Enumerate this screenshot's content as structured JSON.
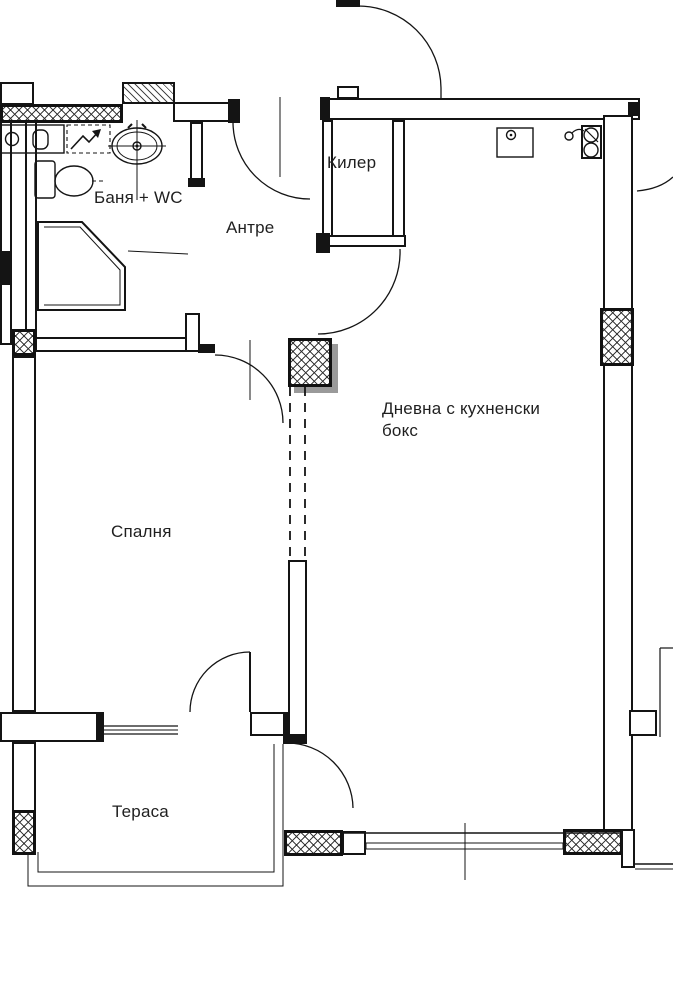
{
  "plan": {
    "background": "#ffffff",
    "ink": "#141414",
    "rooms": {
      "bathroom": {
        "label": "Баня + WC"
      },
      "hallway": {
        "label": "Антре"
      },
      "pantry": {
        "label": "Килер"
      },
      "living": {
        "label": "Дневна с кухненски бокс"
      },
      "bedroom": {
        "label": "Спалня"
      },
      "terrace": {
        "label": "Тераса"
      }
    },
    "fixtures": [
      "toilet",
      "washbasin-counter",
      "shower",
      "bathroom-sink",
      "kitchen-sink",
      "cooktop",
      "faucet",
      "wardrobe"
    ],
    "doors": [
      "entrance-door",
      "bathroom-door",
      "pantry-door",
      "bedroom-door",
      "bedroom-terrace-door",
      "living-terrace-door",
      "neighbor-door"
    ]
  }
}
